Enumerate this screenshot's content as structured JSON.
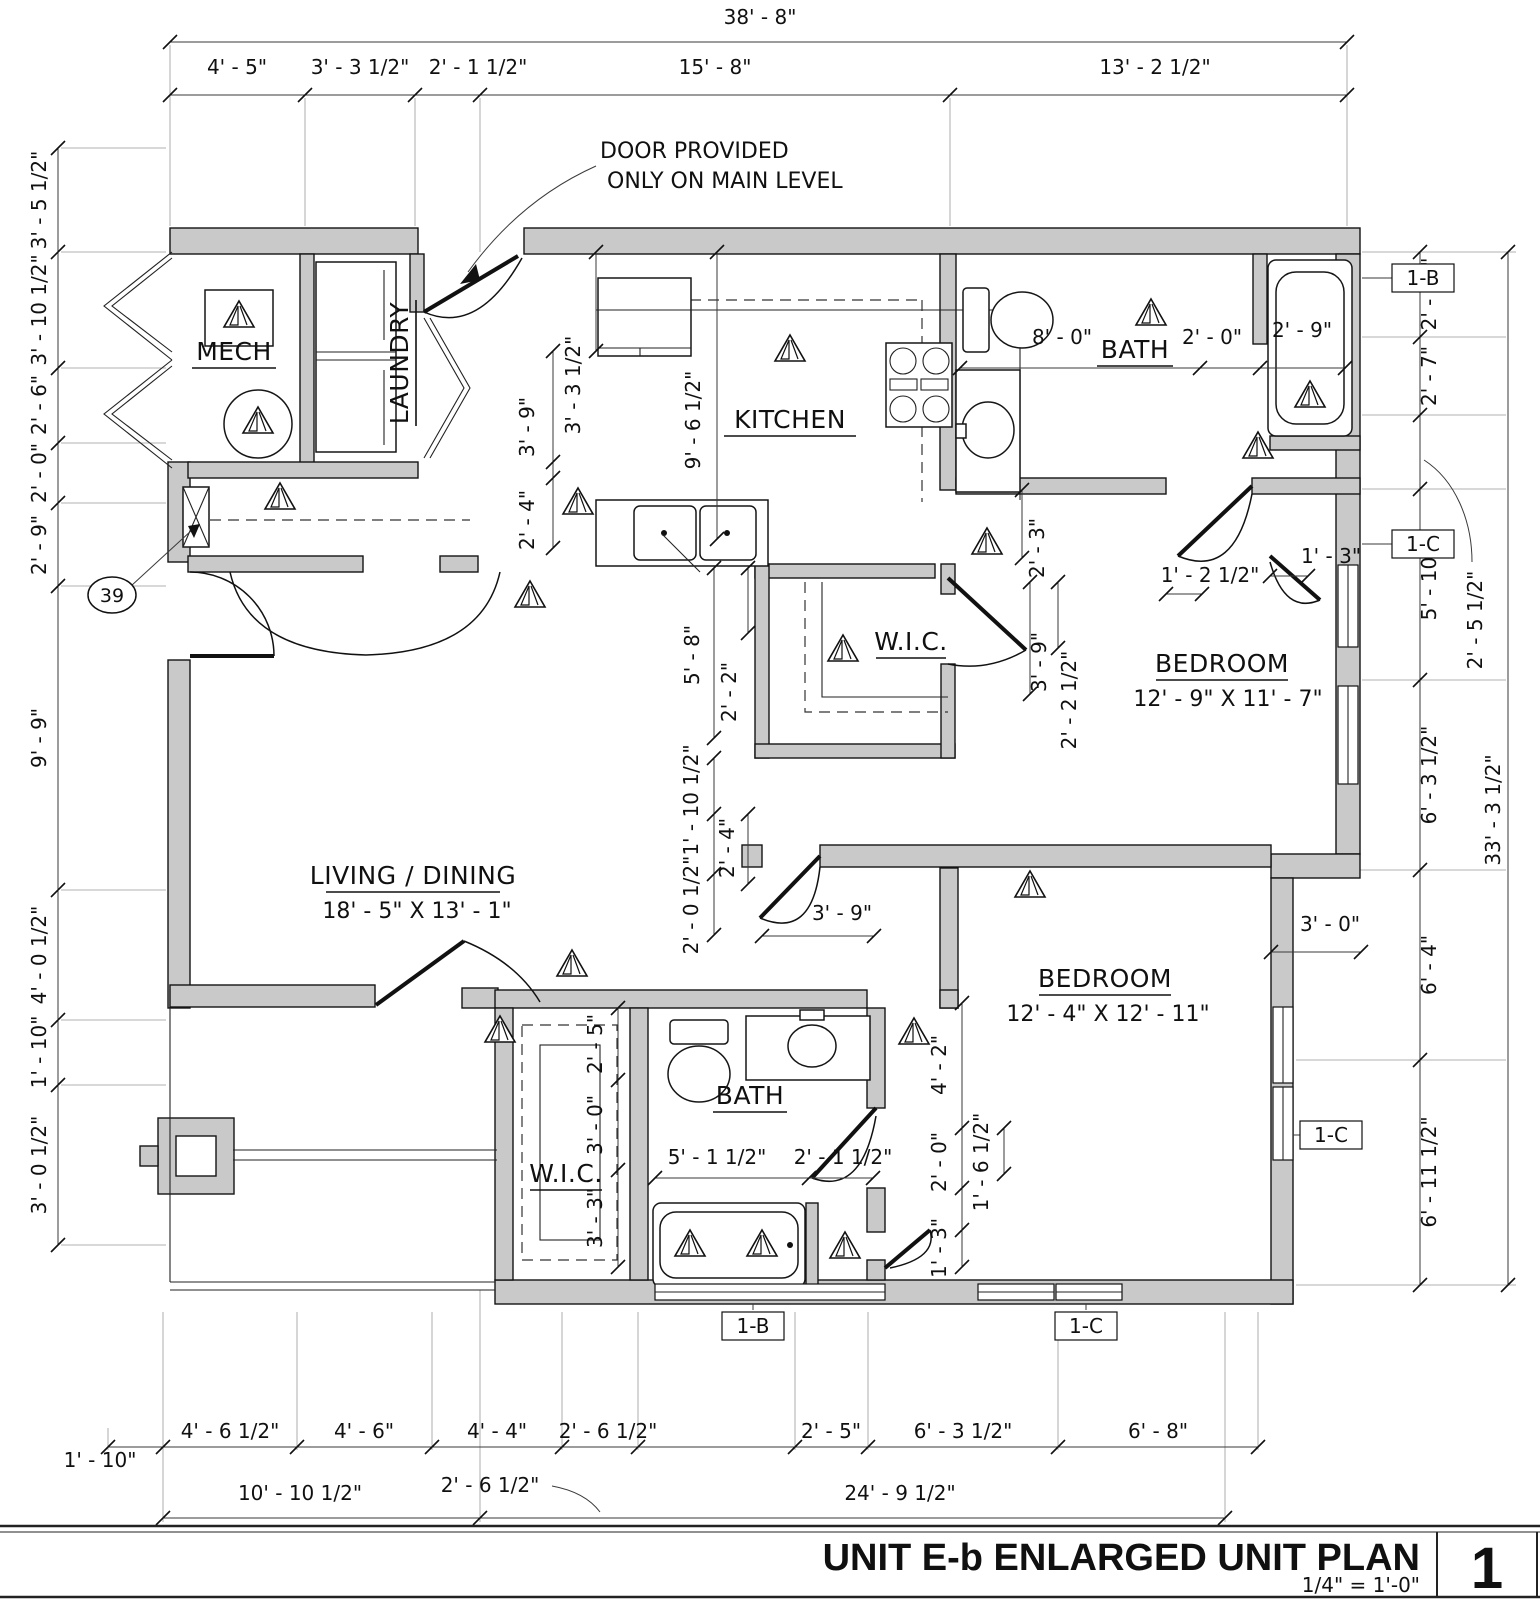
{
  "title_block": {
    "title": "UNIT E-b ENLARGED UNIT PLAN",
    "scale": "1/4\" = 1'-0\"",
    "sheet_number": "1"
  },
  "notes": {
    "door_note_line1": "DOOR PROVIDED",
    "door_note_line2": "ONLY ON MAIN LEVEL",
    "keynote_39": "39"
  },
  "rooms": {
    "mech": {
      "name": "MECH"
    },
    "laundry": {
      "name": "LAUNDRY"
    },
    "kitchen": {
      "name": "KITCHEN"
    },
    "bath_upper": {
      "name": "BATH"
    },
    "wic_upper": {
      "name": "W.I.C."
    },
    "bedroom_upper": {
      "name": "BEDROOM",
      "size": "12' - 9\" X 11' - 7\""
    },
    "living_dining": {
      "name": "LIVING / DINING",
      "size": "18' - 5\" X 13' - 1\""
    },
    "bedroom_lower": {
      "name": "BEDROOM",
      "size": "12' - 4\" X 12' - 11\""
    },
    "bath_lower": {
      "name": "BATH"
    },
    "wic_lower": {
      "name": "W.I.C."
    }
  },
  "wall_tags": {
    "tag_1b": "1-B",
    "tag_1c": "1-C"
  },
  "dims": {
    "top": {
      "overall": "38' - 8\"",
      "segments": [
        "4' - 5\"",
        "3' - 3 1/2\"",
        "2' - 1 1/2\"",
        "15' - 8\"",
        "13' - 2 1/2\""
      ]
    },
    "left": [
      "3' - 5 1/2\"",
      "3' - 10 1/2\"",
      "2' - 6\"",
      "2' - 0\"",
      "2' - 9\"",
      "9' - 9\"",
      "4' - 0 1/2\"",
      "1' - 10\"",
      "3' - 0 1/2\""
    ],
    "right": {
      "segments": [
        "2' - 10\"",
        "2' - 7\"",
        "5' - 10\"",
        "6' - 3 1/2\"",
        "6' - 4\"",
        "6' - 11 1/2\""
      ],
      "leader": "2' - 5 1/2\"",
      "overall": "33' - 3 1/2\""
    },
    "bottom": {
      "row1": [
        "1' - 10\"",
        "4' - 6 1/2\"",
        "4' - 6\"",
        "4' - 4\"",
        "2' - 6 1/2\"",
        "2' - 5\"",
        "6' - 3 1/2\"",
        "6' - 8\""
      ],
      "row2_left": "10' - 10 1/2\"",
      "row2_leader": "2' - 6 1/2\"",
      "row2_right": "24' - 9 1/2\""
    },
    "interior": {
      "kitchen_width": "9' - 6 1/2\"",
      "kitchen_left": "3' - 3 1/2\"",
      "laundry_h": "3' - 9\"",
      "laundry_v": "2' - 4\"",
      "bath_upper_a": "8' - 0\"",
      "bath_upper_b": "2' - 0\"",
      "bath_upper_tub": "2' - 9\"",
      "bath_upper_wall": "2' - 3\"",
      "hall_right_a": "1' - 2 1/2\"",
      "hall_right_b": "1' - 3\"",
      "wic_upper_h": "5' - 8\"",
      "wic_upper_h2": "2' - 2\"",
      "wic_upper_r1": "3' - 9\"",
      "wic_upper_r2": "2' - 2 1/2\"",
      "hall_mid_a": "1' - 10 1/2\"",
      "hall_mid_b": "2' - 0 1/2\"",
      "hall_mid_c": "2' - 4\"",
      "bed1_door": "3' - 9\"",
      "step": "3' - 0\"",
      "bath_lower_a": "5' - 1 1/2\"",
      "bath_lower_b": "2' - 1 1/2\"",
      "wic_lower_a": "2' - 5\"",
      "wic_lower_b": "3' - 0\"",
      "wic_lower_c": "3' - 3\"",
      "bed2_a": "4' - 2\"",
      "bed2_b": "2' - 0\"",
      "bed2_c": "1' - 6 1/2\"",
      "bed2_d": "1' - 3\""
    }
  }
}
